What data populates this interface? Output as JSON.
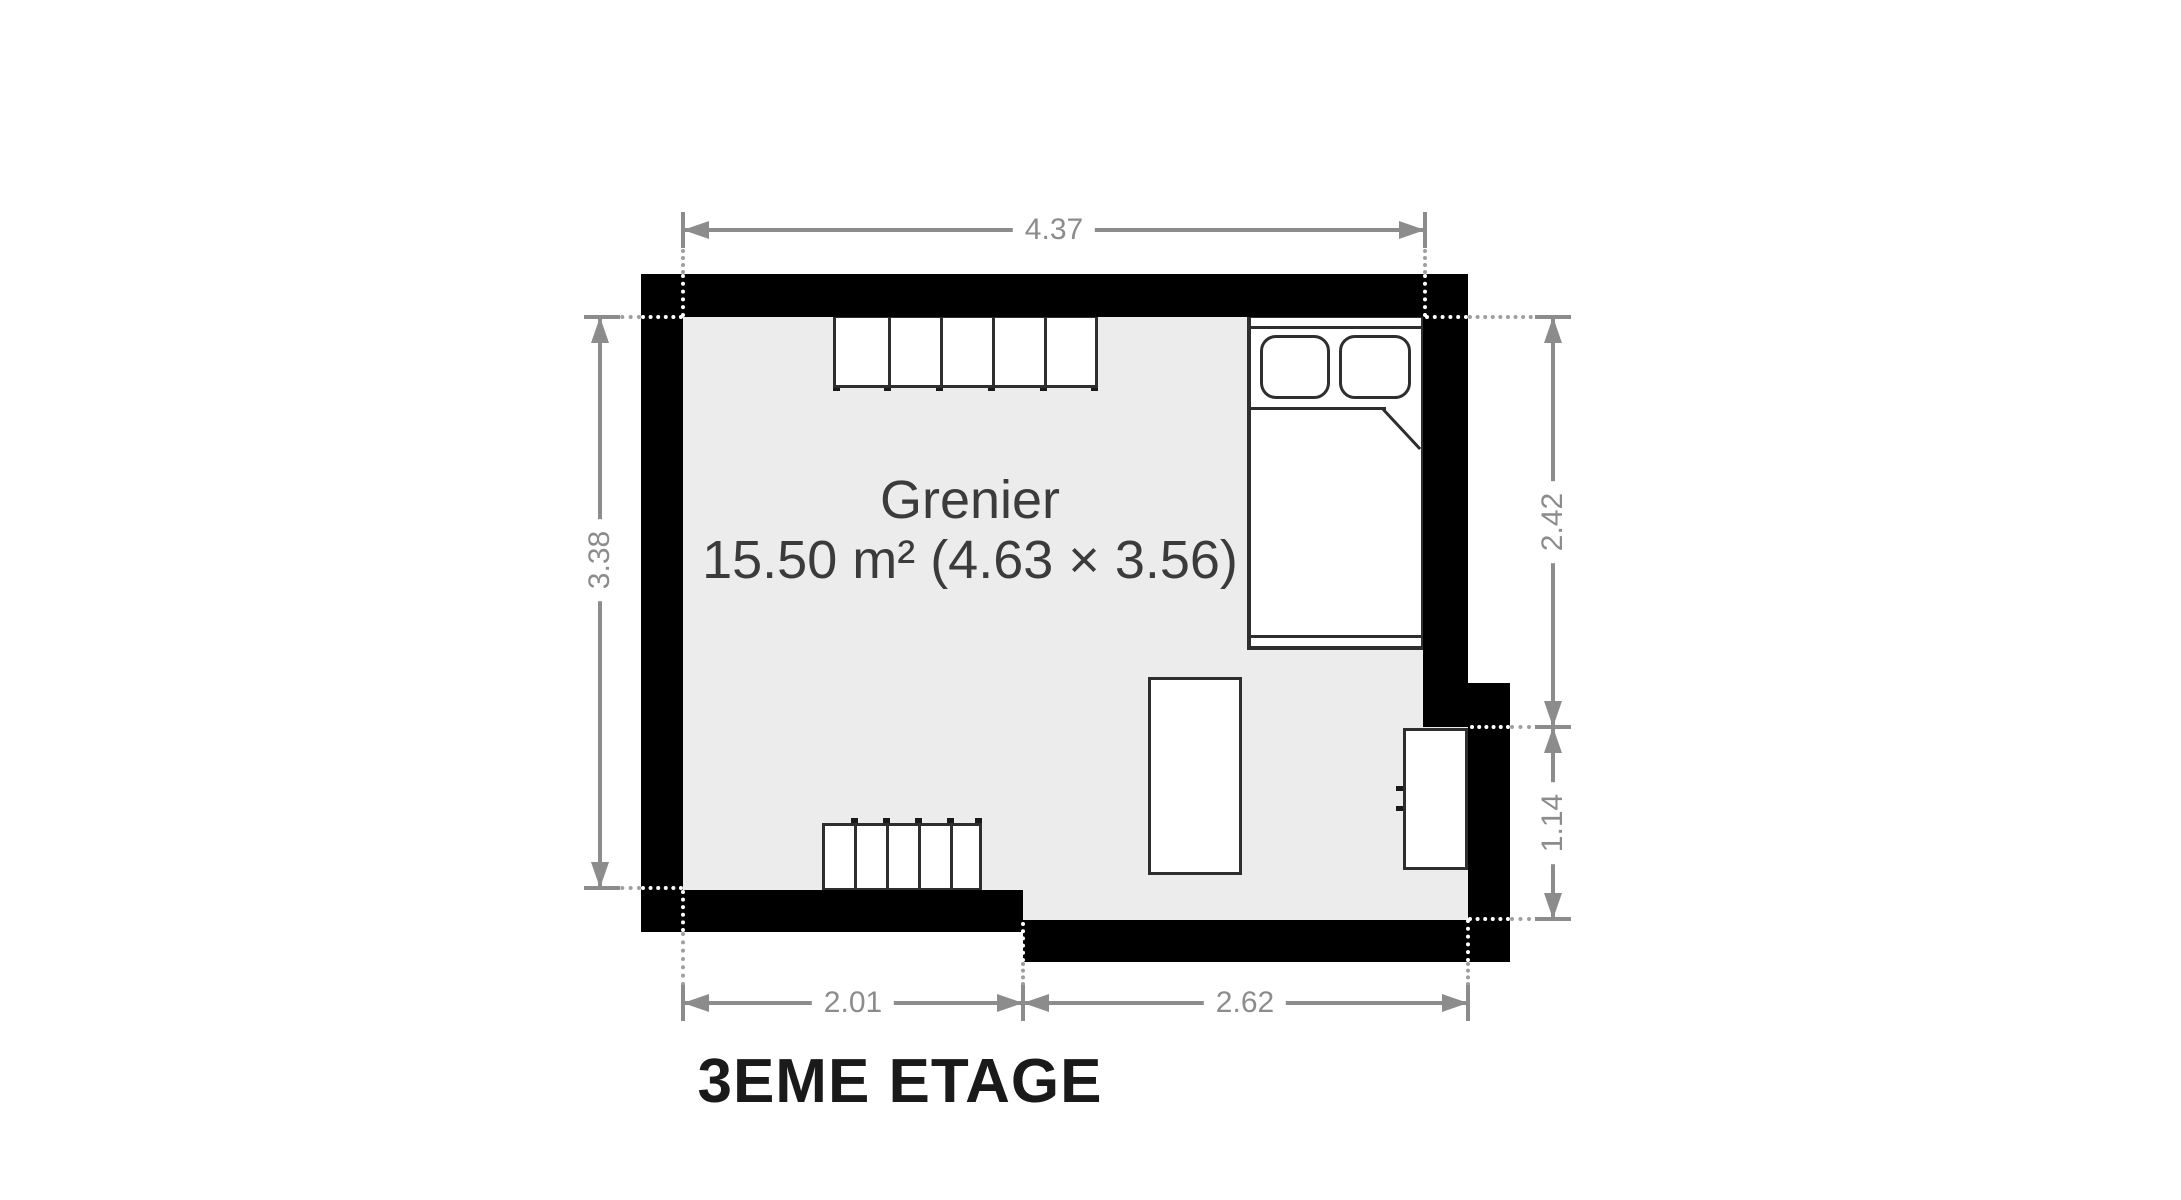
{
  "floor_plan": {
    "title": "3EME ETAGE",
    "room": {
      "name": "Grenier",
      "area_label": "15.50 m² (4.63 × 3.56)"
    },
    "dimensions": {
      "top": "4.37",
      "left": "3.38",
      "right_upper": "2.42",
      "right_lower": "1.14",
      "bottom_left": "2.01",
      "bottom_right": "2.62"
    },
    "furniture": [
      "wardrobe",
      "bed",
      "radiator",
      "table",
      "desk"
    ],
    "colors": {
      "wall": "#000000",
      "floor": "#ececec",
      "dimension": "#8c8c8c",
      "room_text": "#3b3b3b",
      "title_text": "#1a1a1a"
    }
  }
}
